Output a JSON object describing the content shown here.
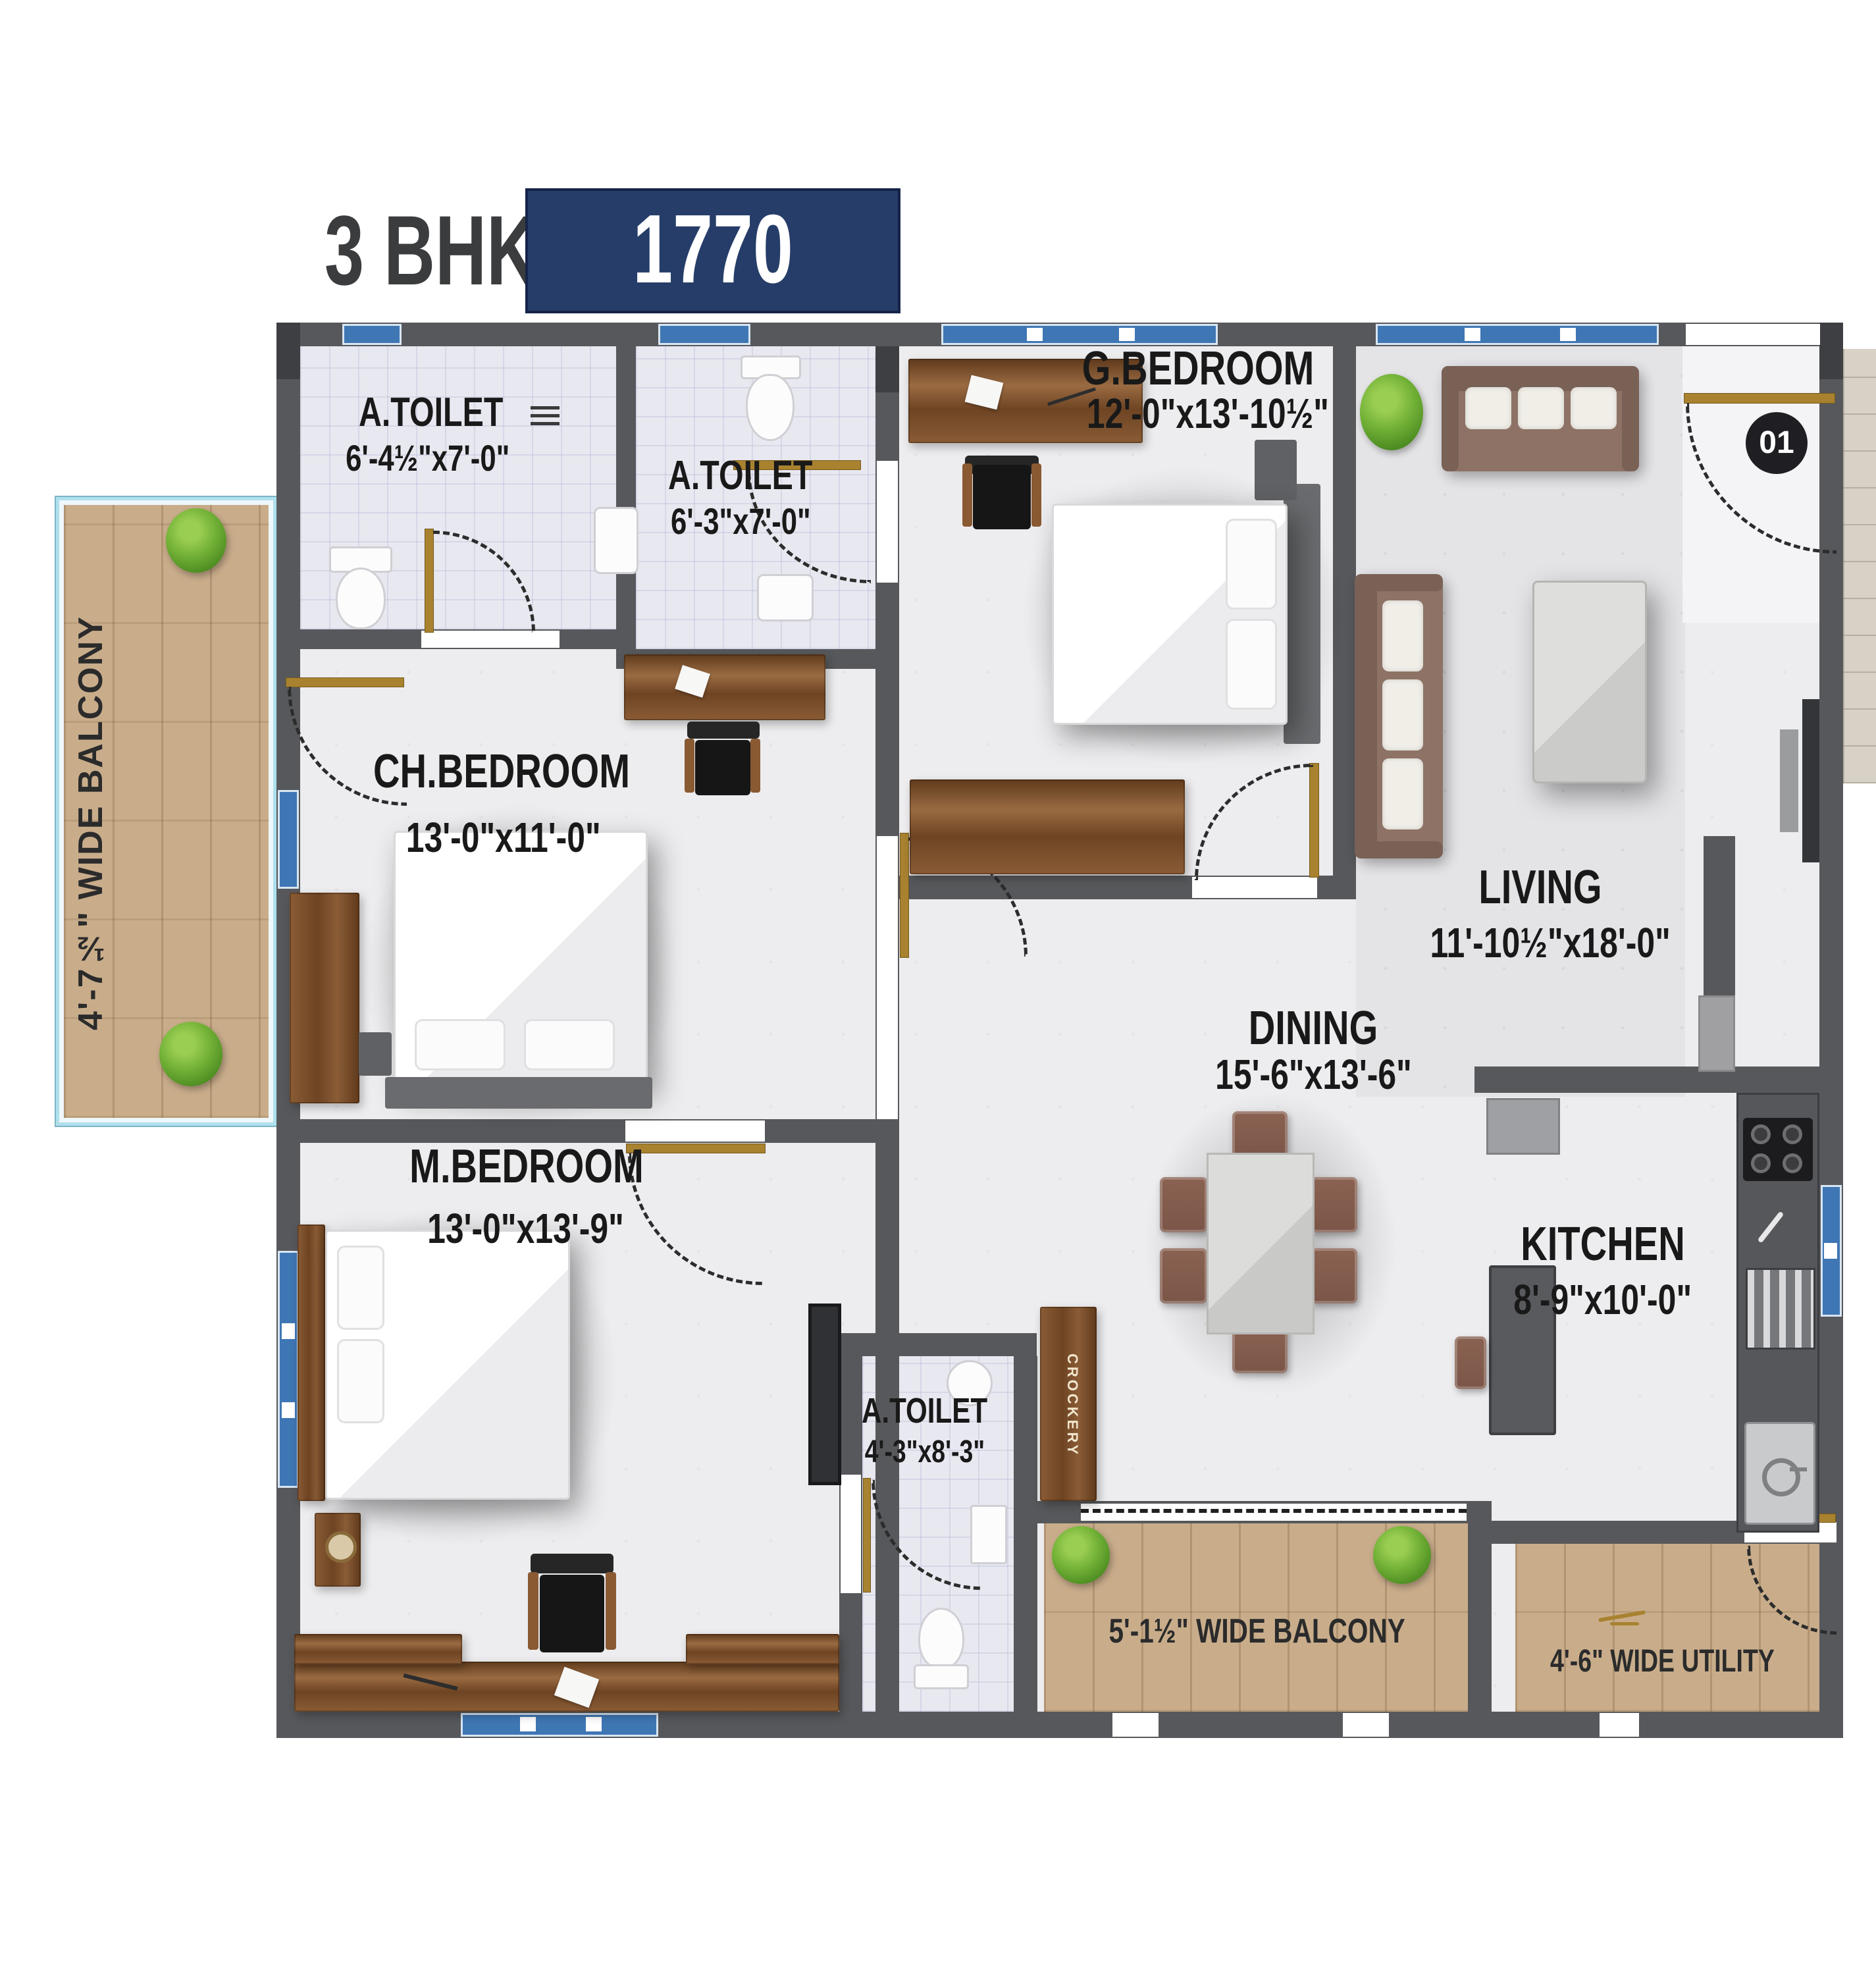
{
  "title": {
    "bhk": "3 BHK",
    "area": "1770 SFT"
  },
  "unit_badge": "01",
  "rooms": [
    {
      "name": "A.TOILET",
      "dims": "6'-4½\"x7'-0\""
    },
    {
      "name": "A.TOILET",
      "dims": "6'-3\"x7'-0\""
    },
    {
      "name": "G.BEDROOM",
      "dims": "12'-0\"x13'-10½\""
    },
    {
      "name": "CH.BEDROOM",
      "dims": "13'-0\"x11'-0\""
    },
    {
      "name": "M.BEDROOM",
      "dims": "13'-0\"x13'-9\""
    },
    {
      "name": "LIVING",
      "dims": "11'-10½\"x18'-0\""
    },
    {
      "name": "DINING",
      "dims": "15'-6\"x13'-6\""
    },
    {
      "name": "KITCHEN",
      "dims": "8'-9\"x10'-0\""
    },
    {
      "name": "A.TOILET",
      "dims": "4'-3\"x8'-3\""
    }
  ],
  "balconies": {
    "left": "4'-7½\" WIDE BALCONY",
    "bottom": "5'-1½\" WIDE BALCONY",
    "utility": "4'-6\" WIDE UTILITY"
  },
  "labels": {
    "crockery": "CROCKERY"
  },
  "colors": {
    "accent_navy": "#263d69",
    "wall_gray": "#57585b",
    "window_blue": "#3f76b4",
    "door_gold": "#a8822f",
    "balcony_wood": "#c9ad8b",
    "plant_green": "#6fae35"
  }
}
